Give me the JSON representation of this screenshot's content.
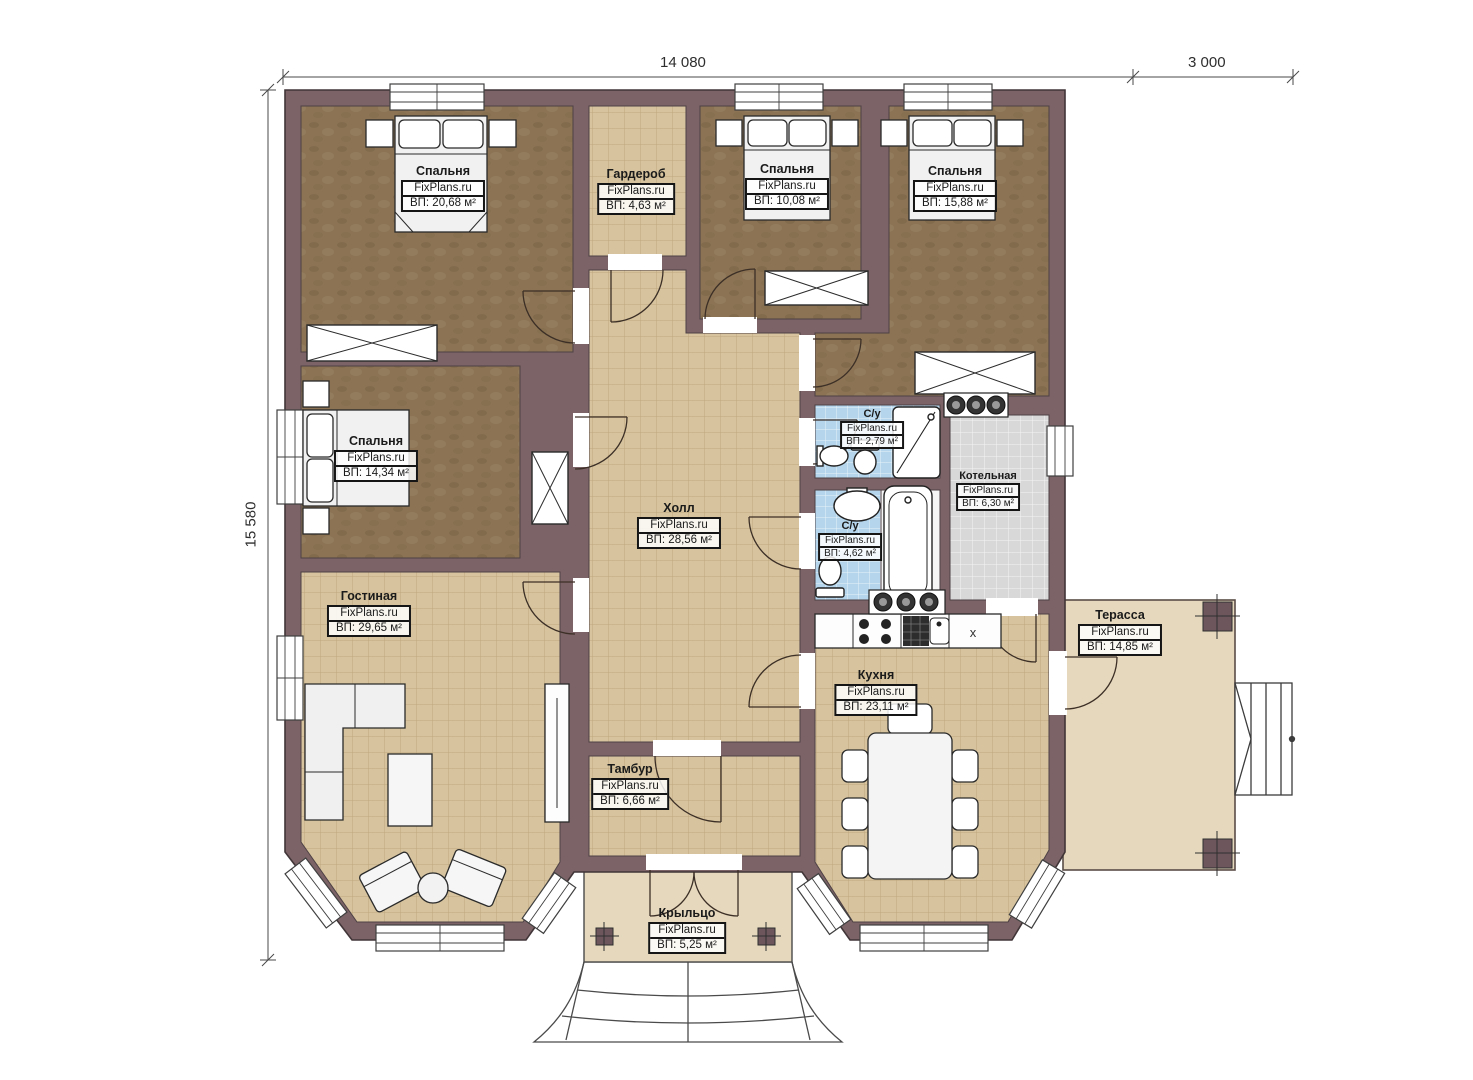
{
  "brand": "FixPlans.ru",
  "dimensions": {
    "width_main": "14 080",
    "width_terrace": "3 000",
    "height": "15 580"
  },
  "rooms": [
    {
      "id": "bedroom-1",
      "name": "Спальня",
      "area": "ВП: 20,68 м²"
    },
    {
      "id": "wardrobe",
      "name": "Гардероб",
      "area": "ВП: 4,63 м²"
    },
    {
      "id": "bedroom-2",
      "name": "Спальня",
      "area": "ВП: 10,08 м²"
    },
    {
      "id": "bedroom-3",
      "name": "Спальня",
      "area": "ВП: 15,88 м²"
    },
    {
      "id": "bedroom-4",
      "name": "Спальня",
      "area": "ВП: 14,34 м²"
    },
    {
      "id": "hall",
      "name": "Холл",
      "area": "ВП: 28,56 м²"
    },
    {
      "id": "living",
      "name": "Гостиная",
      "area": "ВП: 29,65 м²"
    },
    {
      "id": "bath-top",
      "name": "С/у",
      "area": "ВП: 2,79 м²"
    },
    {
      "id": "bath-bottom",
      "name": "С/у",
      "area": "ВП: 4,62 м²"
    },
    {
      "id": "boiler",
      "name": "Котельная",
      "area": "ВП: 6,30 м²"
    },
    {
      "id": "kitchen",
      "name": "Кухня",
      "area": "ВП: 23,11 м²"
    },
    {
      "id": "vestibule",
      "name": "Тамбур",
      "area": "ВП: 6,66 м²"
    },
    {
      "id": "porch",
      "name": "Крыльцо",
      "area": "ВП: 5,25 м²"
    },
    {
      "id": "terrace",
      "name": "Терасса",
      "area": "ВП: 14,85 м²"
    }
  ],
  "colors": {
    "wall": "#7b6367",
    "bedroom_floor": "#8b7354",
    "tile_floor": "#d7c49e",
    "bath_floor": "#b4d5eb",
    "boiler_floor": "#d8d8d8",
    "terrace_floor": "#e6d8bc"
  }
}
